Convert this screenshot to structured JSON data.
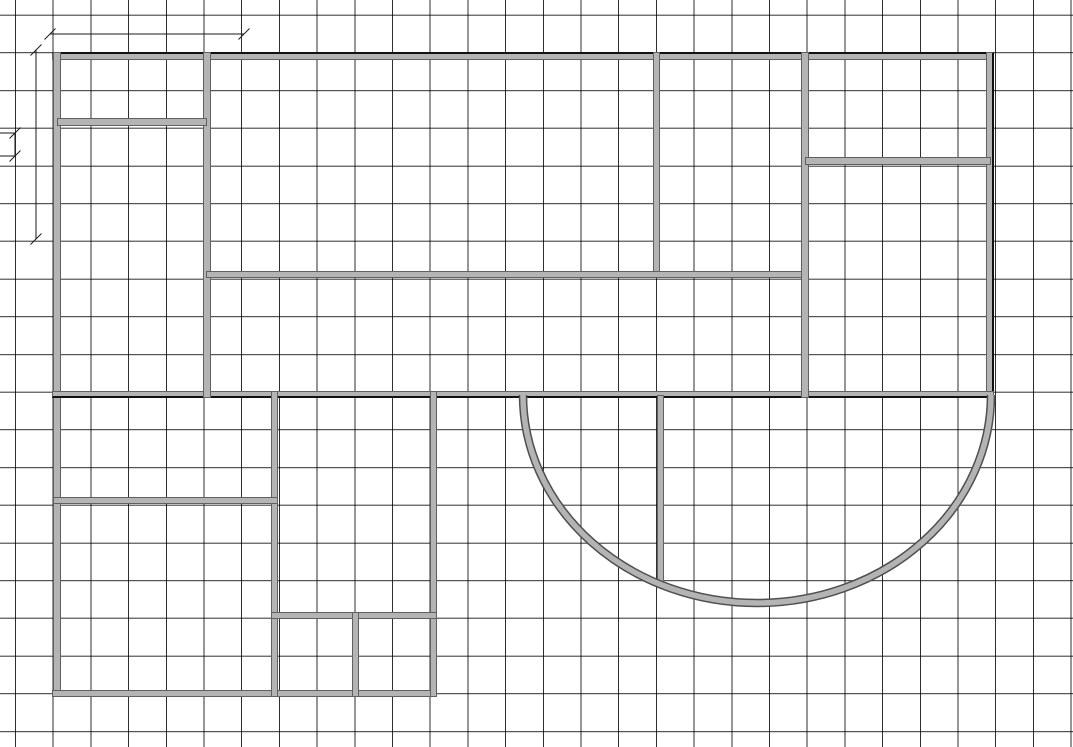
{
  "canvas": {
    "width": 1073,
    "height": 747,
    "background": "#ffffff"
  },
  "grid": {
    "spacing": 37.7,
    "offset_x": 15,
    "offset_y": 14.7,
    "line_color": "rgba(0,0,0,0.82)",
    "line_width": 1
  },
  "style": {
    "wall_fill": "#b4b4b4",
    "wall_edge": "#606060",
    "outer_edge": "#111111",
    "dim_color": "#1a1a1a",
    "tick_half": 5.5
  },
  "walls": [
    {
      "id": "outer-top",
      "x": 52,
      "y": 52,
      "w": 942,
      "h": 8,
      "black": [
        "top"
      ]
    },
    {
      "id": "outer-left",
      "x": 53,
      "y": 52,
      "w": 8,
      "h": 645
    },
    {
      "id": "outer-right",
      "x": 986,
      "y": 52,
      "w": 8,
      "h": 346,
      "black": [
        "right"
      ]
    },
    {
      "id": "mid-chord",
      "x": 52,
      "y": 391,
      "w": 942,
      "h": 7,
      "black": [
        "bottom"
      ]
    },
    {
      "id": "top-v-left",
      "x": 203,
      "y": 52,
      "w": 8,
      "h": 346
    },
    {
      "id": "room-a-divider",
      "x": 57,
      "y": 118,
      "w": 150,
      "h": 8
    },
    {
      "id": "top-v-middle",
      "x": 653,
      "y": 52,
      "w": 7,
      "h": 226
    },
    {
      "id": "top-h-middle",
      "x": 206,
      "y": 271,
      "w": 601,
      "h": 7
    },
    {
      "id": "top-v-right",
      "x": 801,
      "y": 52,
      "w": 8,
      "h": 346
    },
    {
      "id": "right-room-divider",
      "x": 805,
      "y": 157,
      "w": 186,
      "h": 8
    },
    {
      "id": "lower-bottom",
      "x": 52,
      "y": 690,
      "w": 385,
      "h": 7
    },
    {
      "id": "lower-right",
      "x": 430,
      "y": 391,
      "w": 7,
      "h": 306
    },
    {
      "id": "lower-v-middle",
      "x": 271,
      "y": 391,
      "w": 7,
      "h": 306
    },
    {
      "id": "lower-h-left",
      "x": 53,
      "y": 497,
      "w": 225,
      "h": 7
    },
    {
      "id": "lower-h-right",
      "x": 271,
      "y": 612,
      "w": 166,
      "h": 7
    },
    {
      "id": "lower-v-small",
      "x": 352,
      "y": 612,
      "w": 7,
      "h": 85
    },
    {
      "id": "semi-v",
      "x": 657,
      "y": 395,
      "w": 7,
      "h": 188
    }
  ],
  "arc": {
    "cx": 757,
    "cy": 395,
    "rx": 234,
    "ry": 208,
    "edge_width": 8.5,
    "fill_width": 5.5
  },
  "dimension_lines": [
    {
      "id": "top-width",
      "x1": 50,
      "y1": 34,
      "x2": 244,
      "y2": 34
    },
    {
      "id": "left-height",
      "x1": 36,
      "y1": 50,
      "x2": 36,
      "y2": 239
    },
    {
      "id": "left-small",
      "x1": 15,
      "y1": 133,
      "x2": 15,
      "y2": 156
    }
  ],
  "extension_lines": [
    {
      "id": "ext-upper",
      "x1": 0,
      "y1": 133,
      "x2": 16,
      "y2": 133
    },
    {
      "id": "ext-lower",
      "x1": 0,
      "y1": 156,
      "x2": 16,
      "y2": 156
    }
  ]
}
